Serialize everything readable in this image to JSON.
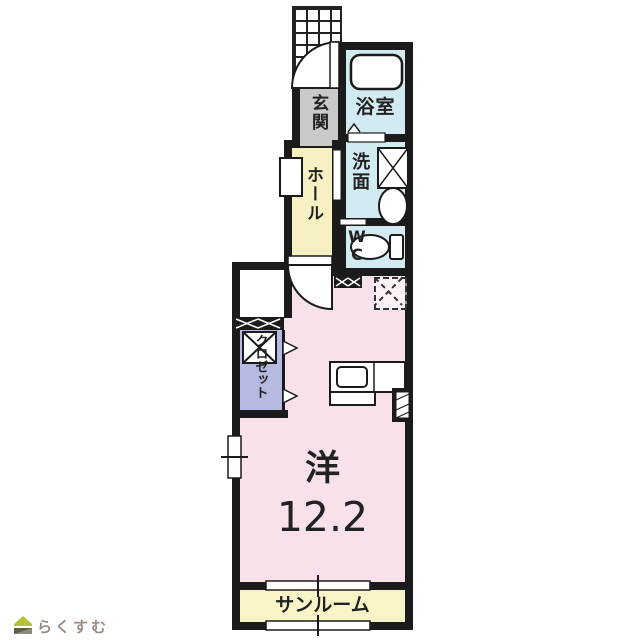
{
  "rooms": {
    "genkan": {
      "label": "玄関",
      "floor_color": "#c9c9c9"
    },
    "bath": {
      "label": "浴室",
      "floor_color": "#d2eaf2"
    },
    "hall": {
      "label": "ホール",
      "floor_color": "#f6f0c3"
    },
    "washroom": {
      "label": "洗面",
      "floor_color": "#d2eaf2"
    },
    "wc": {
      "label": "WC",
      "floor_color": "#d2eaf2"
    },
    "closet": {
      "label": "クロゼット",
      "floor_color": "#b6b9e0"
    },
    "main_room": {
      "label": "洋",
      "size": "12.2",
      "floor_color": "#f8e1ea"
    },
    "sunroom": {
      "label": "サンルーム",
      "floor_color": "#f8f4c8"
    }
  },
  "fixtures": [
    "bathtub",
    "washing-machine",
    "washbasin",
    "toilet",
    "kitchen-counter",
    "kitchen-sink",
    "refrigerator-space",
    "hanger-box",
    "entrance-door",
    "hall-door",
    "folding-doors",
    "windows",
    "porch-grid"
  ],
  "branding": {
    "logo_text": "らくすむ",
    "logo_roof_color": "#b5c234",
    "logo_base_color": "#5f5c52"
  },
  "colors": {
    "wall": "#1b1b1b",
    "background": "#ffffff",
    "text": "#222222"
  }
}
